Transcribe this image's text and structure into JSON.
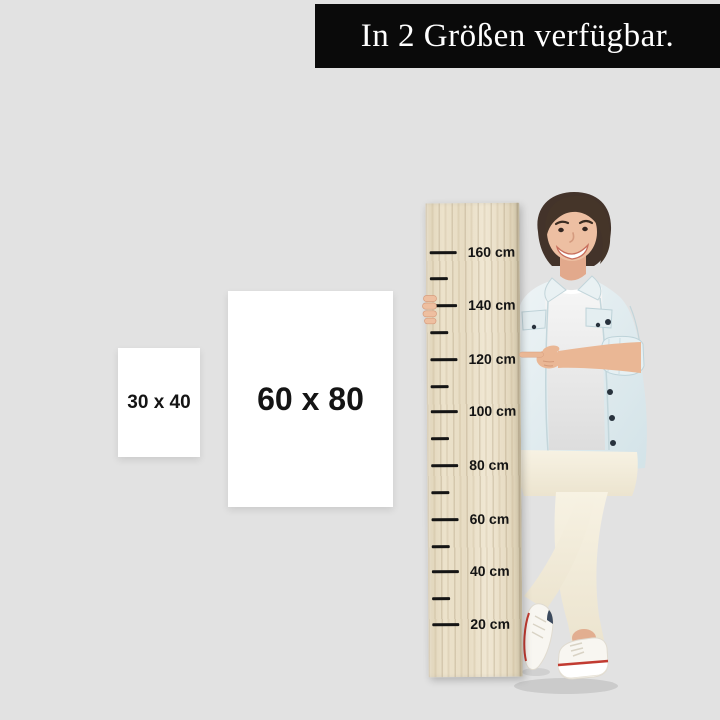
{
  "page": {
    "background_color": "#e2e2e2"
  },
  "banner": {
    "text": "In 2 Größen verfügbar.",
    "background_color": "#0a0a0a",
    "text_color": "#ffffff"
  },
  "size_options": [
    {
      "label": "30 x 40"
    },
    {
      "label": "60 x 80"
    }
  ],
  "ruler": {
    "unit": "cm",
    "labels": [
      "160 cm",
      "140 cm",
      "120 cm",
      "100 cm",
      "80 cm",
      "60 cm",
      "40 cm",
      "20 cm"
    ],
    "wood_color": "#e9dfc7",
    "tick_color": "#151515"
  },
  "figure_colors": {
    "hair": "#43332a",
    "skin": "#eab795",
    "jacket_denim": "#dceaee",
    "tshirt": "#efefef",
    "pants": "#f4eedd",
    "shoe": "#f8f6f1",
    "shoe_accent_red": "#c23b32",
    "shoe_accent_navy": "#3c4a5e"
  }
}
